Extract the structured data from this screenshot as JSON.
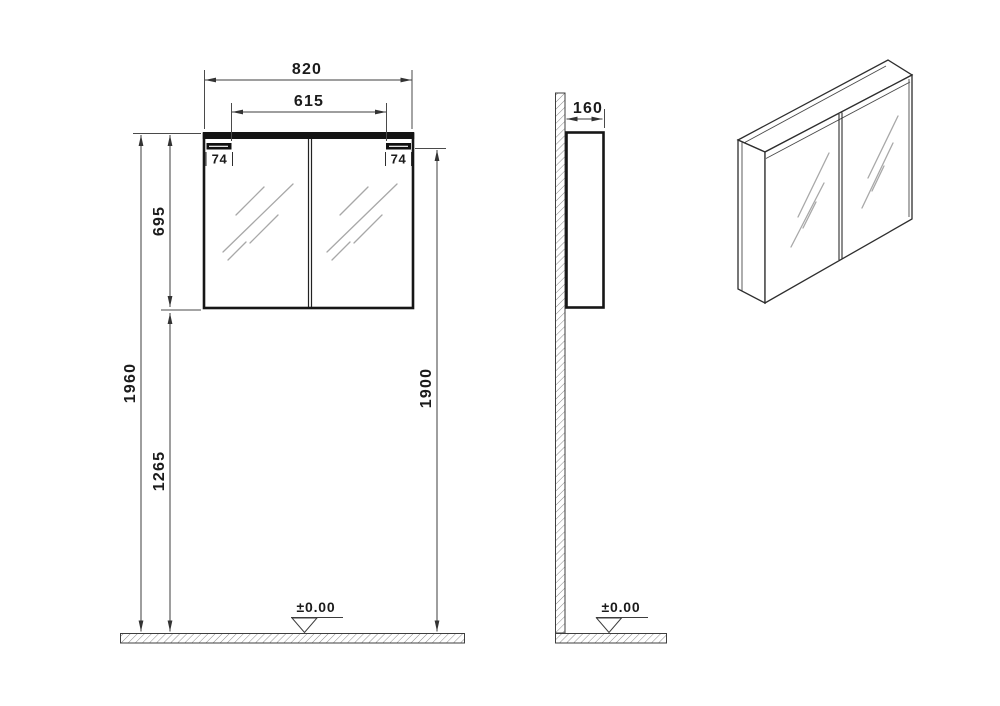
{
  "drawing": {
    "subject": "double-door-mirror-cabinet-technical-drawing",
    "front_view": {
      "overall_width": "820",
      "inner_width": "615",
      "bracket_offset_left": "74",
      "bracket_offset_right": "74",
      "cabinet_height": "695",
      "total_height": "1960",
      "underside_height": "1265",
      "mounting_height": "1900",
      "floor_level": "±0.00"
    },
    "side_view": {
      "depth": "160",
      "floor_level": "±0.00"
    },
    "colors": {
      "background": "#ffffff",
      "outline": "#161616",
      "dimension_lines": "#3d3d3d",
      "mirror_hatch": "#a8a8a8"
    }
  }
}
